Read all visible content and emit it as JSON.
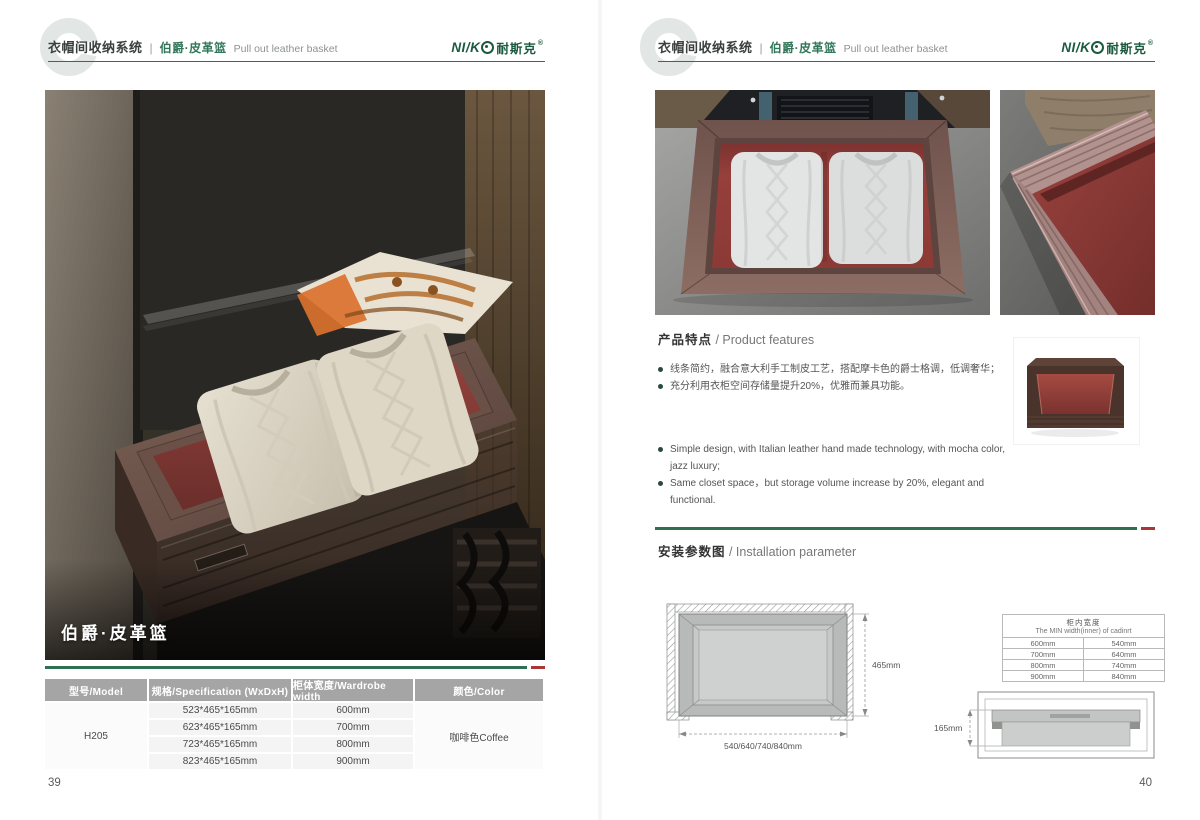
{
  "header": {
    "system": "衣帽间收纳系统",
    "divider": "|",
    "product_zh": "伯爵·皮革篮",
    "product_en": "Pull out leather basket",
    "brand_latin": "NI/K",
    "brand_cn": "耐斯克",
    "brand_reg": "®"
  },
  "left": {
    "photo_caption": "伯爵·皮革篮",
    "page_number": "39",
    "table": {
      "headers": [
        "型号/Model",
        "规格/Specification (WxDxH)",
        "柜体宽度/Wardrobe width",
        "颜色/Color"
      ],
      "model": "H205",
      "rows": [
        {
          "spec": "523*465*165mm",
          "width": "600mm"
        },
        {
          "spec": "623*465*165mm",
          "width": "700mm"
        },
        {
          "spec": "723*465*165mm",
          "width": "800mm"
        },
        {
          "spec": "823*465*165mm",
          "width": "900mm"
        }
      ],
      "color": "咖啡色Coffee"
    }
  },
  "right": {
    "page_number": "40",
    "features": {
      "title_zh": "产品特点",
      "title_en": " / Product features",
      "bullets_zh": [
        "线条简约，融合意大利手工制皮工艺，搭配摩卡色的爵士格调，低调奢华；",
        "充分利用衣柜空间存储量提升20%，优雅而兼具功能。"
      ],
      "bullets_en": [
        "Simple design, with Italian leather hand made technology, with mocha color, jazz  luxury;",
        "Same closet space，but storage volume increase by 20%, elegant and functional."
      ]
    },
    "install": {
      "title_zh": "安装参数图",
      "title_en": " / Installation parameter",
      "top_view": {
        "depth": "465mm",
        "width": "540/640/740/840mm"
      },
      "side_view": {
        "height": "165mm"
      },
      "min_table": {
        "title_zh": "柜内宽度",
        "title_en": "The MIN width(inner) of cadinrt",
        "rows": [
          [
            "600mm",
            "540mm"
          ],
          [
            "700mm",
            "640mm"
          ],
          [
            "800mm",
            "740mm"
          ],
          [
            "900mm",
            "840mm"
          ]
        ]
      }
    }
  }
}
